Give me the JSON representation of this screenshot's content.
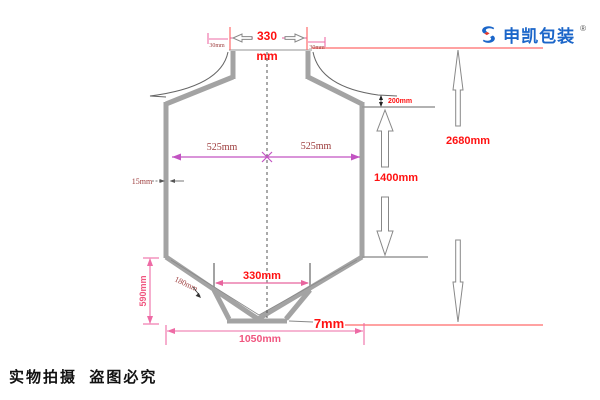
{
  "logo": {
    "brand": "申凯包装",
    "registered_mark": "®"
  },
  "footer": {
    "notice": "实物拍摄  盗图必究"
  },
  "dimensions": {
    "top_opening_value": "330",
    "top_opening_unit": "mm",
    "top_left_offset": "30mm",
    "top_right_offset": "30mm",
    "half_width_left": "525mm",
    "half_width_right": "525mm",
    "wall_thickness": "15mm",
    "shoulder_height": "200mm",
    "body_height": "1400mm",
    "overall_height": "2680mm",
    "discharge_width": "330mm",
    "spout_length": "180mm",
    "cone_height": "590mm",
    "overall_width": "1050mm",
    "bottom_thickness": "7mm"
  },
  "colors": {
    "label_red": "#ff1111",
    "dim_pink": "#ee6ba5",
    "dim_magenta": "#c253c2",
    "label_dark_red": "#9c3b3b",
    "wall_gray": "#a3a3a3",
    "brand_blue": "#1b66c9",
    "brand_red": "#e23a2e"
  }
}
